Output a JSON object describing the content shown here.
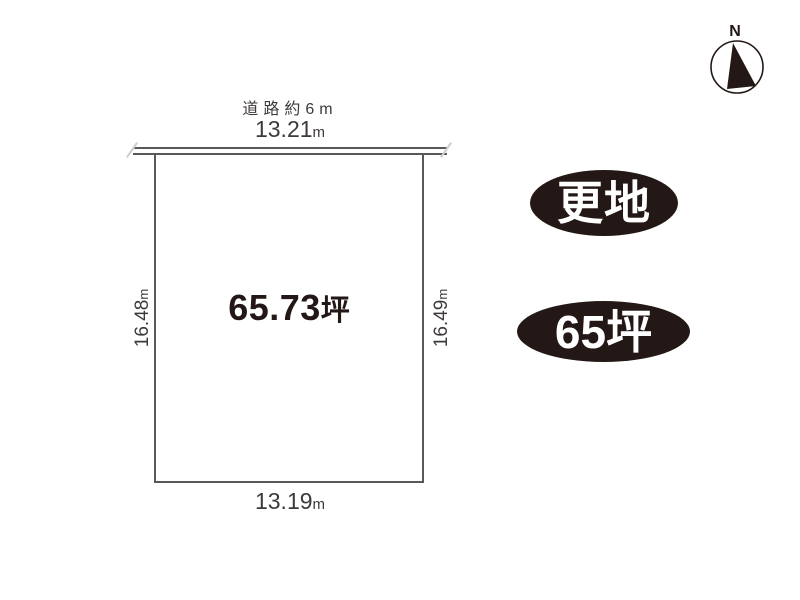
{
  "colors": {
    "ink": "#231815",
    "line_gray": "#595757",
    "dim_text": "#3e3a39",
    "badge_bg": "#231815",
    "badge_text": "#ffffff"
  },
  "compass": {
    "north_label": "N"
  },
  "road": {
    "label": "道路約6m"
  },
  "plot": {
    "area_value": "65.73",
    "area_unit": "坪",
    "dims": {
      "top": {
        "value": "13.21",
        "unit": "m"
      },
      "bottom": {
        "value": "13.19",
        "unit": "m"
      },
      "left": {
        "value": "16.48",
        "unit": "m"
      },
      "right": {
        "value": "16.49",
        "unit": "m"
      }
    }
  },
  "badges": [
    {
      "label": "更地"
    },
    {
      "label": "65坪"
    }
  ]
}
